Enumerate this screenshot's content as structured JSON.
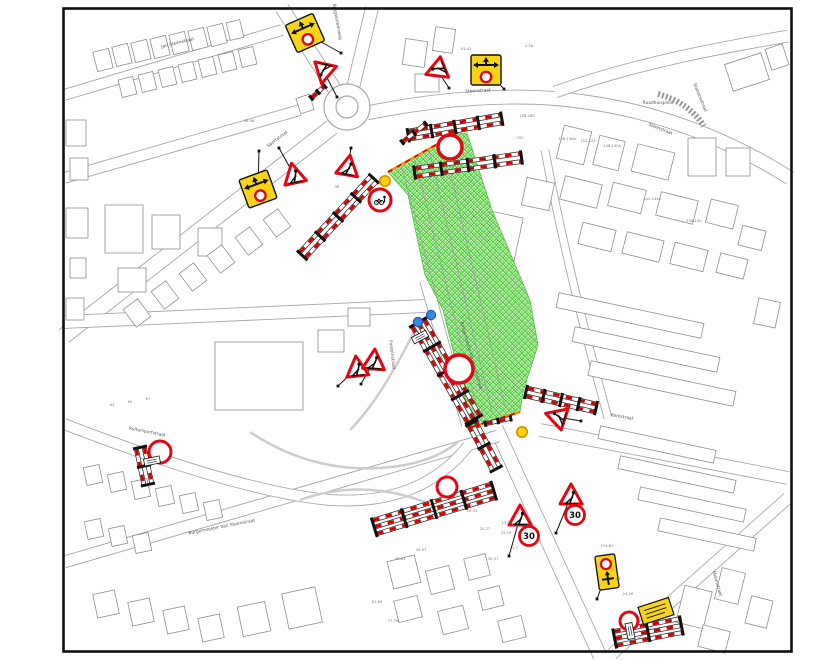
{
  "plan": {
    "type": "roadworks-signage-plan",
    "colors": {
      "barrier_red": "#d40000",
      "sign_red": "#e30613",
      "sign_yellow": "#f7d417",
      "zone_fill": "#e4f9d6",
      "zone_hatch": "#3fc52e",
      "zone_border": "#ff8a00",
      "map_line": "#a8a8a8",
      "building_line": "#909090",
      "lamp_yellow": "#ffd400",
      "marker_blue": "#3a86e0"
    },
    "work_zone": {
      "points": [
        [
          388,
          172
        ],
        [
          455,
          134
        ],
        [
          467,
          133
        ],
        [
          492,
          210
        ],
        [
          530,
          300
        ],
        [
          538,
          345
        ],
        [
          523,
          392
        ],
        [
          520,
          412
        ],
        [
          472,
          427
        ],
        [
          443,
          310
        ],
        [
          425,
          275
        ],
        [
          408,
          195
        ]
      ]
    },
    "street_labels": [
      {
        "text": "Jan Steenstraat",
        "x": 178,
        "y": 44,
        "rot": -14
      },
      {
        "text": "Brugsesteenweg",
        "x": 336,
        "y": 22,
        "rot": 80
      },
      {
        "text": "Steenstraat",
        "x": 478,
        "y": 92,
        "rot": -3
      },
      {
        "text": "Steenstraat",
        "x": 660,
        "y": 130,
        "rot": 22
      },
      {
        "text": "Raadhuisplein",
        "x": 658,
        "y": 104,
        "rot": 0
      },
      {
        "text": "Stationsstraat",
        "x": 699,
        "y": 98,
        "rot": 68
      },
      {
        "text": "Sportstraat",
        "x": 278,
        "y": 140,
        "rot": -37
      },
      {
        "text": "Fonteinstraat",
        "x": 391,
        "y": 355,
        "rot": 83
      },
      {
        "text": "Burgemeester Vandammestraat",
        "x": 470,
        "y": 356,
        "rot": 74
      },
      {
        "text": "Ruitersportstraat",
        "x": 147,
        "y": 433,
        "rot": 11
      },
      {
        "text": "Burgemeester Van Steenstraat",
        "x": 222,
        "y": 528,
        "rot": -11
      },
      {
        "text": "Kerkstraat",
        "x": 622,
        "y": 418,
        "rot": 10
      },
      {
        "text": "Molenstraat",
        "x": 716,
        "y": 584,
        "rot": 74
      }
    ],
    "house_numbers": [
      {
        "text": "41-43",
        "x": 466,
        "y": 50
      },
      {
        "text": "2-2b",
        "x": 529,
        "y": 47
      },
      {
        "text": "56-58",
        "x": 249,
        "y": 122
      },
      {
        "text": "158-260",
        "x": 527,
        "y": 117
      },
      {
        "text": "252",
        "x": 520,
        "y": 139
      },
      {
        "text": "156-156a",
        "x": 567,
        "y": 140
      },
      {
        "text": "152-154",
        "x": 588,
        "y": 142
      },
      {
        "text": "148-150a",
        "x": 612,
        "y": 147
      },
      {
        "text": "142-144a",
        "x": 652,
        "y": 200
      },
      {
        "text": "138-140",
        "x": 694,
        "y": 222
      },
      {
        "text": "63",
        "x": 112,
        "y": 406
      },
      {
        "text": "65",
        "x": 130,
        "y": 403
      },
      {
        "text": "67",
        "x": 148,
        "y": 400
      },
      {
        "text": "36",
        "x": 337,
        "y": 188
      },
      {
        "text": "45-57",
        "x": 421,
        "y": 551
      },
      {
        "text": "59-61",
        "x": 400,
        "y": 560
      },
      {
        "text": "29-31",
        "x": 472,
        "y": 512
      },
      {
        "text": "25-27",
        "x": 485,
        "y": 530
      },
      {
        "text": "15-19",
        "x": 506,
        "y": 534
      },
      {
        "text": "35-37",
        "x": 493,
        "y": 560
      },
      {
        "text": "13-15",
        "x": 507,
        "y": 524
      },
      {
        "text": "1-7",
        "x": 515,
        "y": 549
      },
      {
        "text": "57a-61",
        "x": 607,
        "y": 547
      },
      {
        "text": "24-26",
        "x": 628,
        "y": 595
      },
      {
        "text": "28",
        "x": 618,
        "y": 580
      },
      {
        "text": "77-79",
        "x": 393,
        "y": 622
      },
      {
        "text": "81-85",
        "x": 377,
        "y": 603
      }
    ],
    "signs": [
      {
        "type": "f41",
        "x": 305,
        "y": 33,
        "rot": -24,
        "anchor": [
          341,
          53
        ]
      },
      {
        "type": "f41",
        "x": 486,
        "y": 70,
        "rot": 0,
        "anchor": [
          504,
          89
        ]
      },
      {
        "type": "f41",
        "x": 258,
        "y": 189,
        "rot": -20,
        "anchor": [
          259,
          151
        ]
      },
      {
        "type": "f41v",
        "x": 607,
        "y": 572,
        "rot": -8,
        "anchor": [
          597,
          599
        ]
      },
      {
        "type": "plate",
        "x": 656,
        "y": 611,
        "rot": -18
      },
      {
        "type": "tri",
        "x": 324,
        "y": 72,
        "rot": 192,
        "anchor": [
          337,
          97
        ]
      },
      {
        "type": "tri",
        "x": 437,
        "y": 70,
        "rot": -112,
        "anchor": [
          449,
          88
        ]
      },
      {
        "type": "tri",
        "x": 294,
        "y": 175,
        "rot": -12,
        "anchor": [
          279,
          148
        ]
      },
      {
        "type": "tri",
        "x": 348,
        "y": 167,
        "rot": 10,
        "anchor": [
          351,
          148
        ]
      },
      {
        "type": "tri",
        "x": 357,
        "y": 368,
        "rot": -6,
        "anchor": [
          338,
          386
        ]
      },
      {
        "type": "tri",
        "x": 374,
        "y": 361,
        "rot": 4,
        "anchor": [
          361,
          384
        ]
      },
      {
        "type": "tri",
        "x": 557,
        "y": 417,
        "rot": -72,
        "anchor": [
          581,
          421
        ]
      },
      {
        "type": "tri",
        "x": 520,
        "y": 517,
        "rot": 0,
        "anchor": [
          509,
          556
        ]
      },
      {
        "type": "tri",
        "x": 571,
        "y": 496,
        "rot": 0,
        "anchor": [
          556,
          533
        ]
      },
      {
        "type": "s30",
        "x": 529,
        "y": 536,
        "label": "30"
      },
      {
        "type": "s30",
        "x": 575,
        "y": 515,
        "label": "30"
      },
      {
        "type": "c3",
        "x": 450,
        "y": 147,
        "r": 12
      },
      {
        "type": "c3",
        "x": 459,
        "y": 369,
        "r": 14
      },
      {
        "type": "c3",
        "x": 447,
        "y": 487,
        "r": 10
      },
      {
        "type": "c3",
        "x": 160,
        "y": 452,
        "r": 11
      },
      {
        "type": "c3",
        "x": 629,
        "y": 621,
        "r": 9
      },
      {
        "type": "c3pb",
        "x": 380,
        "y": 200,
        "r": 11
      },
      {
        "type": "lamp",
        "x": 385,
        "y": 181
      },
      {
        "type": "lamp",
        "x": 522,
        "y": 432
      },
      {
        "type": "bluedot",
        "x": 418,
        "y": 322
      },
      {
        "type": "bluedot",
        "x": 431,
        "y": 315
      },
      {
        "type": "wplate",
        "x": 152,
        "y": 461,
        "rot": 78
      },
      {
        "type": "wplate",
        "x": 630,
        "y": 631,
        "rot": -11
      },
      {
        "type": "wplate",
        "x": 420,
        "y": 337,
        "rot": 62
      }
    ],
    "barriers": [
      {
        "x": 455,
        "y": 127,
        "len": 95,
        "rot": -10,
        "rows": 2
      },
      {
        "x": 468,
        "y": 165,
        "len": 108,
        "rot": -8,
        "rows": 2
      },
      {
        "x": 338,
        "y": 217,
        "len": 105,
        "rot": -47,
        "rows": 2
      },
      {
        "x": 414,
        "y": 133,
        "len": 30,
        "rot": -38,
        "rows": 1
      },
      {
        "x": 318,
        "y": 92,
        "len": 18,
        "rot": -42,
        "rows": 1
      },
      {
        "x": 446,
        "y": 371,
        "len": 112,
        "rot": 60,
        "rows": 3
      },
      {
        "x": 484,
        "y": 446,
        "len": 52,
        "rot": 62,
        "rows": 2
      },
      {
        "x": 434,
        "y": 509,
        "len": 125,
        "rot": -17,
        "rows": 3
      },
      {
        "x": 561,
        "y": 400,
        "len": 72,
        "rot": 13,
        "rows": 2
      },
      {
        "x": 144,
        "y": 466,
        "len": 38,
        "rot": 78,
        "rows": 2
      },
      {
        "x": 648,
        "y": 632,
        "len": 68,
        "rot": -11,
        "rows": 3
      },
      {
        "x": 498,
        "y": 421,
        "len": 26,
        "rot": -12,
        "rows": 1
      }
    ],
    "zone_border_lines": [
      {
        "x1": 388,
        "y1": 172,
        "x2": 455,
        "y2": 134
      },
      {
        "x1": 472,
        "y1": 427,
        "x2": 520,
        "y2": 412
      }
    ]
  }
}
